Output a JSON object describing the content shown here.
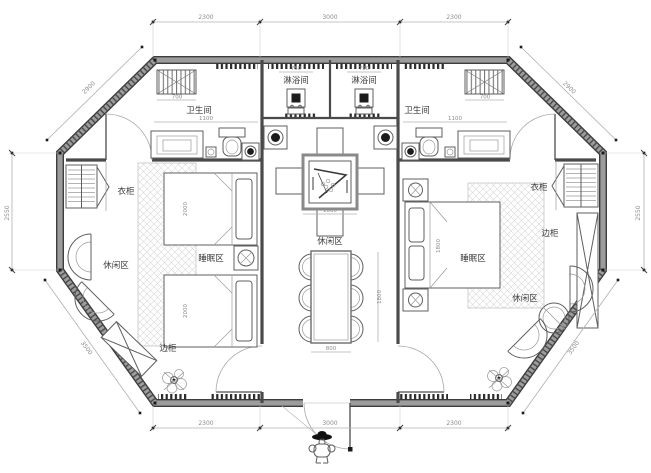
{
  "plan": {
    "labels": {
      "shower_left": "淋浴间",
      "shower_right": "淋浴间",
      "bath_left": "卫生间",
      "bath_right": "卫生间",
      "wardrobe_left": "衣柜",
      "wardrobe_right": "衣柜",
      "sleep_left": "睡眠区",
      "sleep_right": "睡眠区",
      "leisure_left": "休闲区",
      "leisure_center": "休闲区",
      "leisure_right": "休闲区",
      "cabinet_left": "边柜",
      "cabinet_right": "边柜"
    },
    "dims": {
      "top": [
        "2300",
        "3000",
        "2300"
      ],
      "bottom": [
        "2300",
        "3000",
        "2300"
      ],
      "left_side": "2550",
      "right_side": "2550",
      "diag_top_left": "2900",
      "diag_top_right": "2900",
      "diag_bottom_left": "3500",
      "diag_bottom_right": "3500",
      "interior": [
        "700",
        "700",
        "1100",
        "1100",
        "750",
        "750",
        "1000",
        "800",
        "1800",
        "2000",
        "2000",
        "1800"
      ]
    },
    "colors": {
      "wall": "#8f8f8f",
      "wall_edge": "#3d3d3d",
      "furniture_line": "#5f5f5f",
      "dim_line": "#b0b0b0",
      "dim_text": "#8c8c8c",
      "label_text": "#3b3b3b",
      "hatch": "#d8d8d8",
      "dark_fill": "#1c1c1c",
      "background": "#ffffff"
    }
  }
}
